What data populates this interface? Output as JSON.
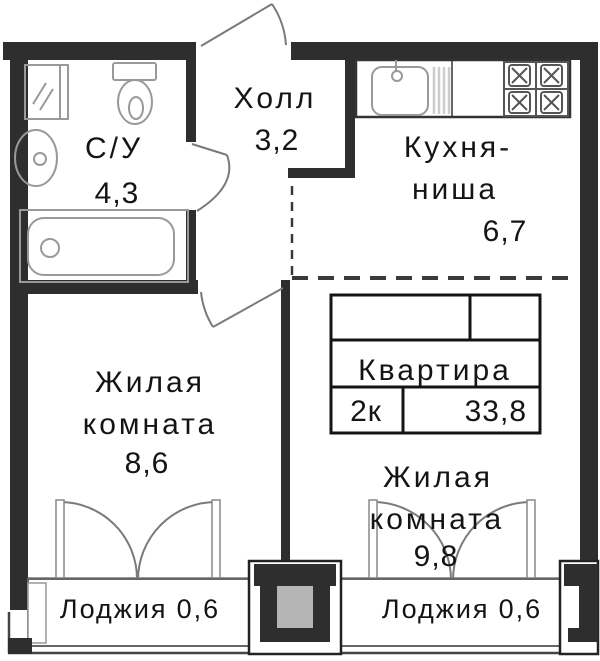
{
  "floor_plan": {
    "rooms": {
      "bathroom": {
        "name": "С/У",
        "area": "4,3"
      },
      "hall": {
        "name": "Холл",
        "area": "3,2"
      },
      "kitchen_niche": {
        "line1": "Кухня-",
        "line2": "ниша",
        "area": "6,7"
      },
      "living_room_left": {
        "line1": "Жилая",
        "line2": "комната",
        "area": "8,6"
      },
      "living_room_right": {
        "line1": "Жилая",
        "line2": "комната",
        "area": "9,8"
      },
      "loggia_left": {
        "name": "Лоджия",
        "area": "0,6"
      },
      "loggia_right": {
        "name": "Лоджия",
        "area": "0,6"
      }
    },
    "info_box": {
      "title": "Квартира",
      "rooms_count": "2к",
      "total_area": "33,8"
    },
    "icons": [
      "washing-machine-icon",
      "toilet-icon",
      "sink-icon",
      "bathtub-icon",
      "kitchen-sink-icon",
      "dish-rack-icon",
      "stove-icon"
    ],
    "colors": {
      "wall": "#2e2e2e",
      "fixture_line": "#999999",
      "door_line": "#7a7a7a",
      "dashed_line": "#3a3a3a",
      "text": "#141414",
      "background": "#ffffff",
      "pillar_center": "#b5b5b5"
    }
  }
}
